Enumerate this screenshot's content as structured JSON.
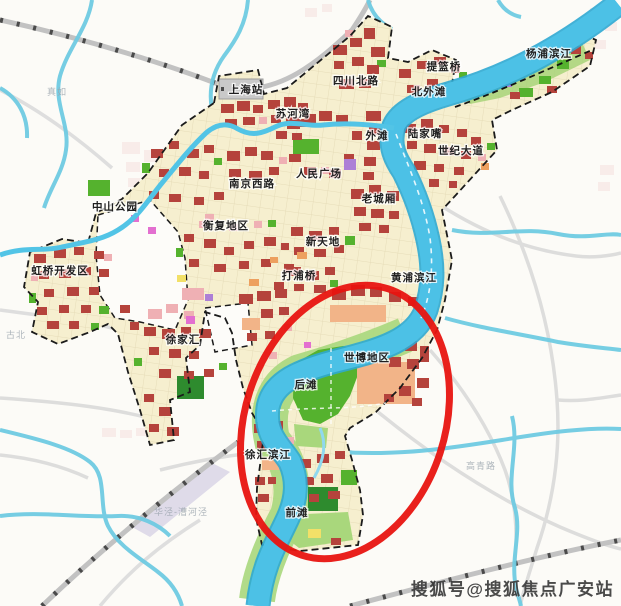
{
  "map": {
    "colors": {
      "land_cream": "#f6efcf",
      "water": "#4cc1e6",
      "water_edge": "#2fa8d2",
      "parcel_red": "#b5433c",
      "parcel_pink": "#efb0b4",
      "parcel_peach": "#f2b488",
      "parcel_purple": "#ad7fd6",
      "parcel_magenta": "#e36fd0",
      "parcel_orange": "#eda05f",
      "parcel_yellow": "#f2e068",
      "park_green": "#55b22e",
      "park_dark_green": "#2e8b2e",
      "park_light_green": "#a9d77c",
      "boundary": "#1b1b1b",
      "highlight_red": "#e81410"
    },
    "labels": [
      {
        "text": "上海站",
        "x": 246,
        "y": 93,
        "kind": "district"
      },
      {
        "text": "苏河湾",
        "x": 293,
        "y": 117,
        "kind": "district"
      },
      {
        "text": "四川北路",
        "x": 356,
        "y": 84,
        "kind": "district"
      },
      {
        "text": "提篮桥",
        "x": 444,
        "y": 70,
        "kind": "district"
      },
      {
        "text": "北外滩",
        "x": 429,
        "y": 95,
        "kind": "district"
      },
      {
        "text": "杨浦滨江",
        "x": 549,
        "y": 57,
        "kind": "district"
      },
      {
        "text": "外滩",
        "x": 377,
        "y": 139,
        "kind": "district"
      },
      {
        "text": "陆家嘴",
        "x": 425,
        "y": 137,
        "kind": "district"
      },
      {
        "text": "世纪大道",
        "x": 461,
        "y": 154,
        "kind": "district"
      },
      {
        "text": "人民广场",
        "x": 319,
        "y": 177,
        "kind": "district"
      },
      {
        "text": "南京西路",
        "x": 252,
        "y": 187,
        "kind": "district"
      },
      {
        "text": "老城厢",
        "x": 379,
        "y": 202,
        "kind": "district"
      },
      {
        "text": "衡复地区",
        "x": 226,
        "y": 229,
        "kind": "district"
      },
      {
        "text": "新天地",
        "x": 323,
        "y": 245,
        "kind": "district"
      },
      {
        "text": "中山公园",
        "x": 115,
        "y": 210,
        "kind": "district"
      },
      {
        "text": "虹桥开发区",
        "x": 60,
        "y": 274,
        "kind": "district"
      },
      {
        "text": "徐家汇",
        "x": 183,
        "y": 343,
        "kind": "district"
      },
      {
        "text": "打浦桥",
        "x": 299,
        "y": 279,
        "kind": "district"
      },
      {
        "text": "黄浦滨江",
        "x": 414,
        "y": 281,
        "kind": "district"
      },
      {
        "text": "世博地区",
        "x": 367,
        "y": 361,
        "kind": "district"
      },
      {
        "text": "后滩",
        "x": 306,
        "y": 388,
        "kind": "district"
      },
      {
        "text": "徐汇滨江",
        "x": 268,
        "y": 458,
        "kind": "district"
      },
      {
        "text": "前滩",
        "x": 297,
        "y": 516,
        "kind": "district"
      },
      {
        "text": "真如",
        "x": 57,
        "y": 95,
        "kind": "faint"
      },
      {
        "text": "古北",
        "x": 16,
        "y": 338,
        "kind": "faint"
      },
      {
        "text": "高青路",
        "x": 481,
        "y": 469,
        "kind": "faint"
      },
      {
        "text": "华泾-漕河泾",
        "x": 181,
        "y": 515,
        "kind": "faint"
      }
    ]
  },
  "watermark": {
    "text": "搜狐号@搜狐焦点广安站"
  }
}
